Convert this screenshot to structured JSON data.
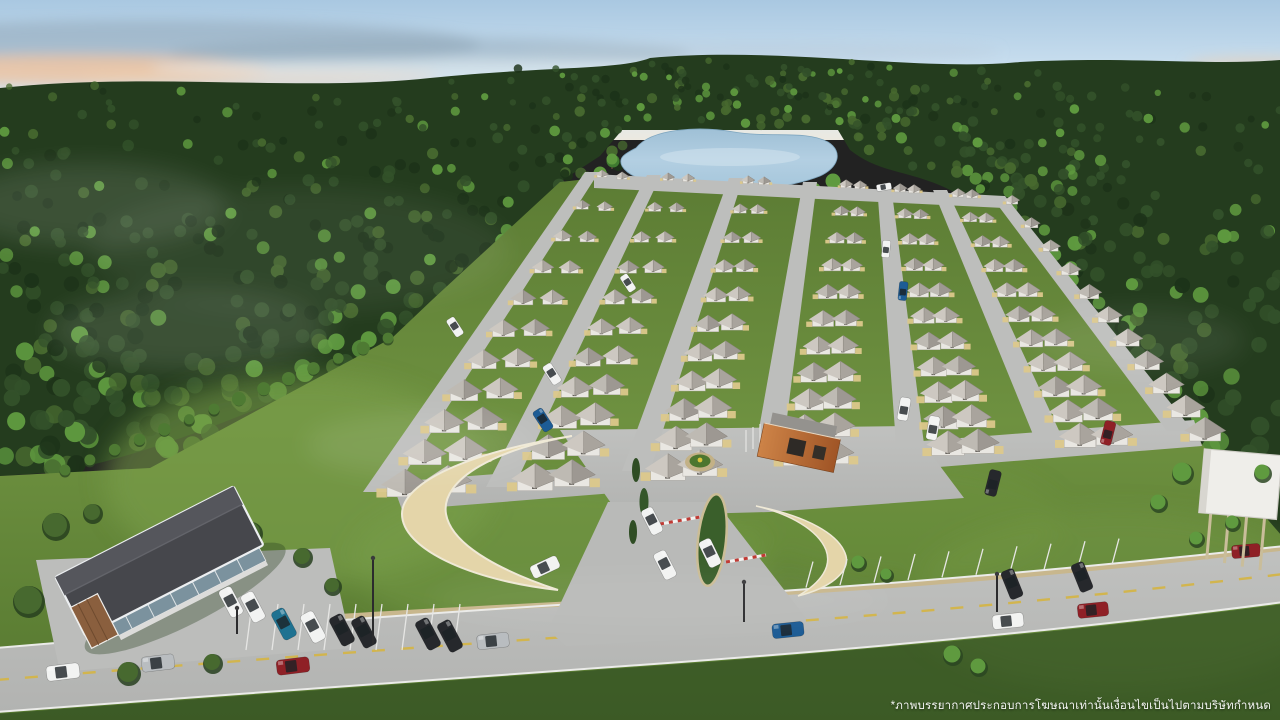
{
  "overlay": {
    "disclaimer": "*ภาพบรรยากาศประกอบการโฆษณาเท่านั้นเงื่อนไขเป็นไปตามบริษัทกำหนด"
  },
  "scene": {
    "type": "aerial-architectural-render",
    "subject": "housing-estate-surrounded-by-forest-with-pond-entrance-gate-clubhouse-and-main-road",
    "palette": {
      "sky_top": "#a9c8e1",
      "sky_mid": "#cfe2f0",
      "sky_low": "#e9edef",
      "cloud_pink": "#edc4a2",
      "cloud_grey": "#8fa5b6",
      "cloud_white": "#e3ecf2",
      "forest_dark": "#243c1e",
      "forest_mid": "#33512a",
      "forest_deep": "#1d3319",
      "forest_light": "#47692f",
      "tree_bright": "#5f9a3f",
      "hedge": "#4e7a33",
      "pond": "#a9cade",
      "pond_light": "#cfe2ee",
      "lawn": "#5f7f36",
      "lawn_bright": "#7ba04a",
      "grass_dark": "#2c4720",
      "road": "#b7b8b6",
      "road_light": "#c3c4c2",
      "roof_light": "#cdc8c1",
      "roof_mid": "#a9a49d",
      "roof_edge": "#8a857e",
      "wall": "#e9e7e2",
      "driveway": "#dcc88b",
      "cream_wall": "#e4d5a9",
      "cream_light": "#efe9d6",
      "clubhouse_roof": "#46474c",
      "clubhouse_roof2": "#55565c",
      "wood": "#8a5f3e",
      "glass": "#7b929e",
      "guard_orange": "#c1763c",
      "guard_orange_dark": "#a05526",
      "lane_yellow": "#d2b54e",
      "marking": "#ebebe9",
      "sidewalk": "#c8b78d",
      "billboard": "#efeeea",
      "car_white": "#f2f3f2",
      "car_silver": "#b9bdc0",
      "car_red": "#8f2026",
      "car_blue": "#1d5c95",
      "car_teal": "#1f7291",
      "car_black": "#26282c"
    }
  }
}
